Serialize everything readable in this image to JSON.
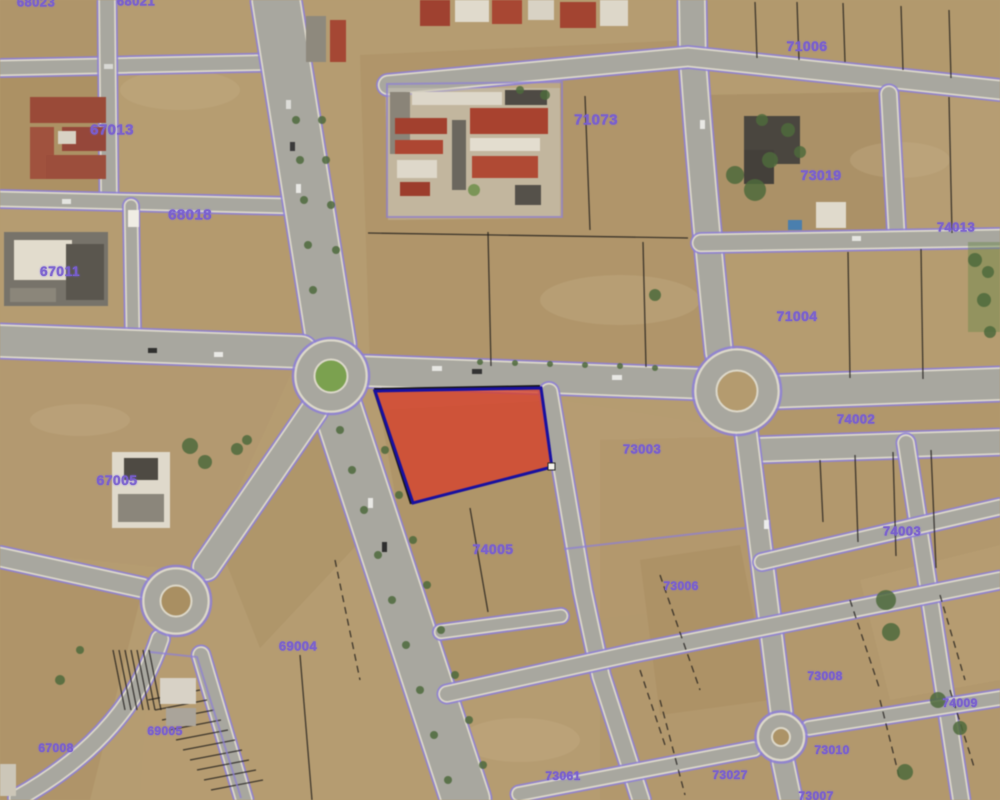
{
  "title": "Aerial cadastral map with highlighted parcel",
  "map": {
    "colors": {
      "terrain": "#b59c71",
      "road": "#a8a79f",
      "road_edge": "#dcd8ca",
      "boundary": "#8d7fd6",
      "label": "#7a5fd0",
      "highlight_fill": "#d7402c",
      "highlight_border": "#1810a0",
      "roundabout_green": "#7ba14f"
    },
    "highlighted_parcel": {
      "points": "375,391 541,388 552,467 413,503",
      "vertex_marker": {
        "x": 548,
        "y": 463
      }
    },
    "labels": [
      {
        "text": "68023",
        "x": 36,
        "y": 2,
        "size": 13
      },
      {
        "text": "68021",
        "x": 136,
        "y": 1,
        "size": 13
      },
      {
        "text": "67013",
        "x": 112,
        "y": 130,
        "size": 15
      },
      {
        "text": "68018",
        "x": 190,
        "y": 215,
        "size": 15
      },
      {
        "text": "67011",
        "x": 60,
        "y": 271,
        "size": 14
      },
      {
        "text": "71073",
        "x": 596,
        "y": 120,
        "size": 15
      },
      {
        "text": "71006",
        "x": 807,
        "y": 46,
        "size": 14
      },
      {
        "text": "73019",
        "x": 821,
        "y": 175,
        "size": 14
      },
      {
        "text": "71004",
        "x": 797,
        "y": 316,
        "size": 14
      },
      {
        "text": "74013",
        "x": 956,
        "y": 227,
        "size": 13
      },
      {
        "text": "67005",
        "x": 117,
        "y": 480,
        "size": 14
      },
      {
        "text": "73003",
        "x": 642,
        "y": 449,
        "size": 13
      },
      {
        "text": "74002",
        "x": 856,
        "y": 419,
        "size": 13
      },
      {
        "text": "74003",
        "x": 902,
        "y": 531,
        "size": 13
      },
      {
        "text": "74005",
        "x": 493,
        "y": 549,
        "size": 14
      },
      {
        "text": "69004",
        "x": 298,
        "y": 646,
        "size": 13
      },
      {
        "text": "69005",
        "x": 165,
        "y": 731,
        "size": 12
      },
      {
        "text": "67008",
        "x": 56,
        "y": 748,
        "size": 12
      },
      {
        "text": "73006",
        "x": 681,
        "y": 586,
        "size": 12
      },
      {
        "text": "73008",
        "x": 825,
        "y": 676,
        "size": 12
      },
      {
        "text": "73010",
        "x": 832,
        "y": 750,
        "size": 12
      },
      {
        "text": "73027",
        "x": 730,
        "y": 775,
        "size": 12
      },
      {
        "text": "74009",
        "x": 960,
        "y": 703,
        "size": 12
      },
      {
        "text": "73061",
        "x": 563,
        "y": 776,
        "size": 12
      },
      {
        "text": "73007",
        "x": 816,
        "y": 796,
        "size": 12
      }
    ]
  }
}
